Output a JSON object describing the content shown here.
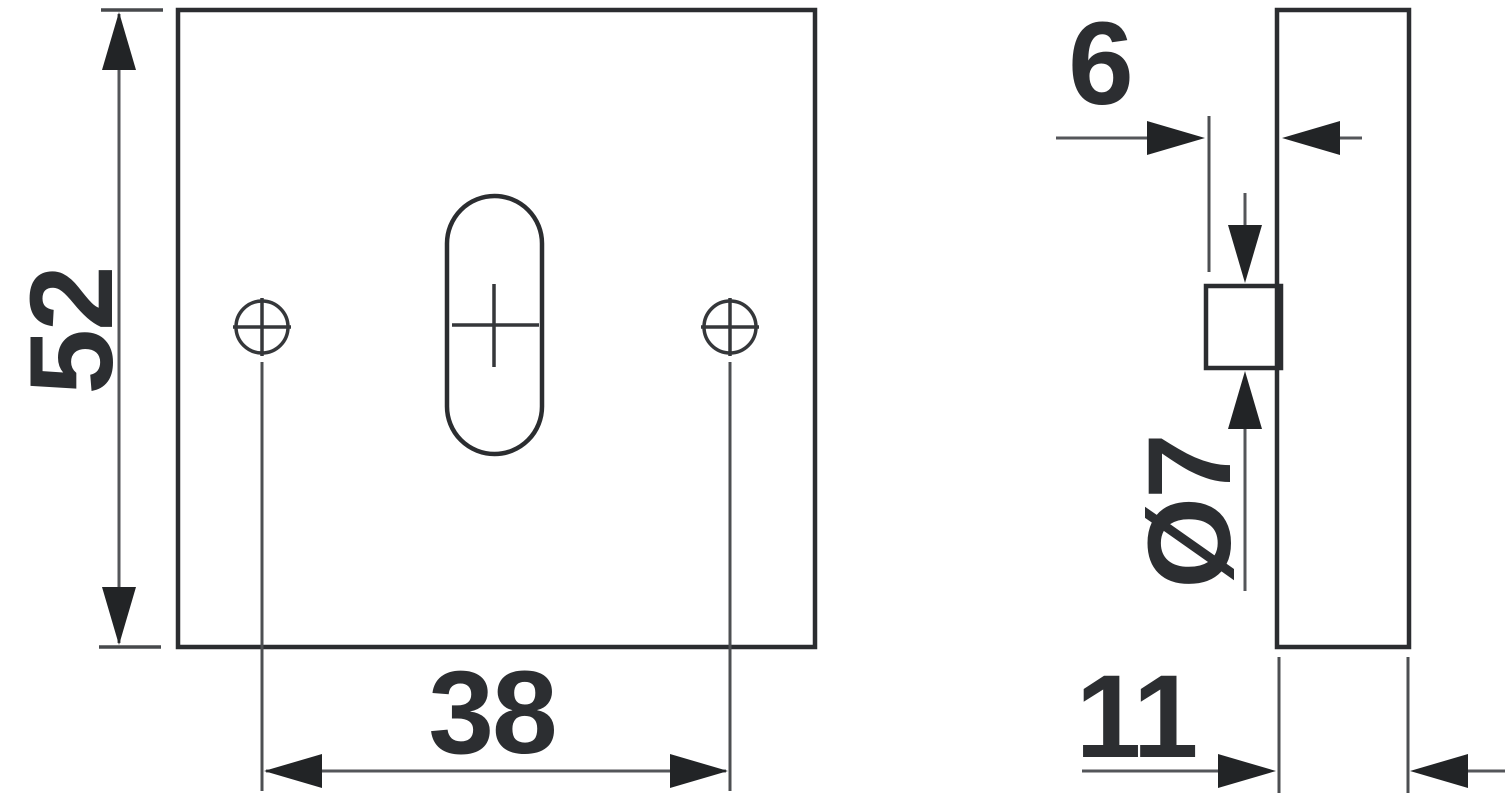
{
  "drawing": {
    "kind": "technical-dimension-drawing",
    "part": "square mounting plate with slot and boss",
    "colors": {
      "background": "#ffffff",
      "outline": "#2b2d30",
      "dimension_lines": "#54565a",
      "text": "#2c2e31"
    },
    "front_view": {
      "height_dim": "52",
      "hole_spacing_dim": "38"
    },
    "side_view": {
      "boss_protrusion_dim": "6",
      "boss_diameter_dim": "Ø7",
      "thickness_dim": "11"
    }
  }
}
